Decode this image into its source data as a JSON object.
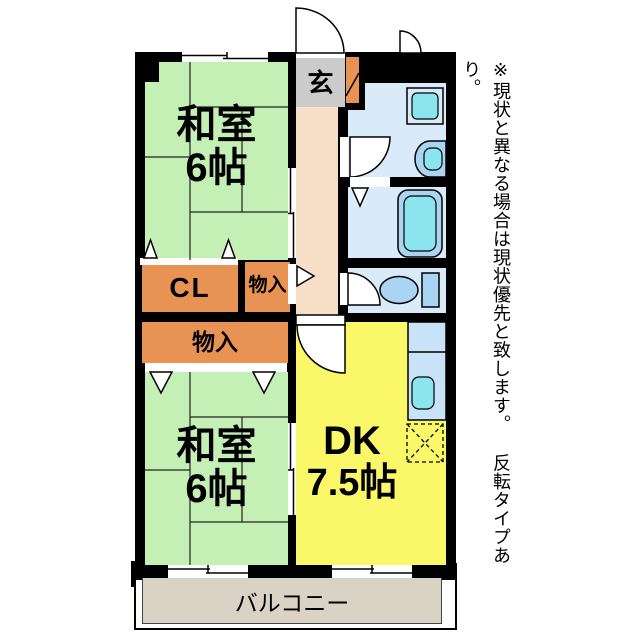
{
  "plan": {
    "rooms": {
      "washitsu1": {
        "name": "和室",
        "size": "6帖"
      },
      "washitsu2": {
        "name": "和室",
        "size": "6帖"
      },
      "dk": {
        "name": "DK",
        "size": "7.5帖"
      },
      "genkan": {
        "label": "玄"
      },
      "closet": {
        "label": "CL"
      },
      "storage1": {
        "label": "物入"
      },
      "storage2": {
        "label": "物入"
      },
      "balcony": {
        "label": "バルコニー"
      }
    },
    "fixtures": [
      "entrance-door",
      "small-window-door",
      "washroom-door",
      "toilet-door",
      "dk-door",
      "bath-folding-door",
      "washing-machine",
      "vanity-sink",
      "bathtub",
      "toilet",
      "kitchen-counter",
      "kitchen-sink",
      "refrigerator-space",
      "shoe-cabinet",
      "sliding-window",
      "closet-door-markers"
    ],
    "colors": {
      "wall": "#000000",
      "tatami": "#C4EFB5",
      "storage": "#E89353",
      "dk": "#FAF768",
      "genkan": "#CBCBCB",
      "hallway": "#F7DEC6",
      "wet_area": "#D9EAF8",
      "fixture": "#A9D4F2",
      "fixture_inner": "#8BE5EF",
      "counter": "#C8E3F7",
      "balcony": "#D9D2C5"
    },
    "note": "※現状と異なる場合は現状優先と致します。 反転タイプあり。"
  }
}
